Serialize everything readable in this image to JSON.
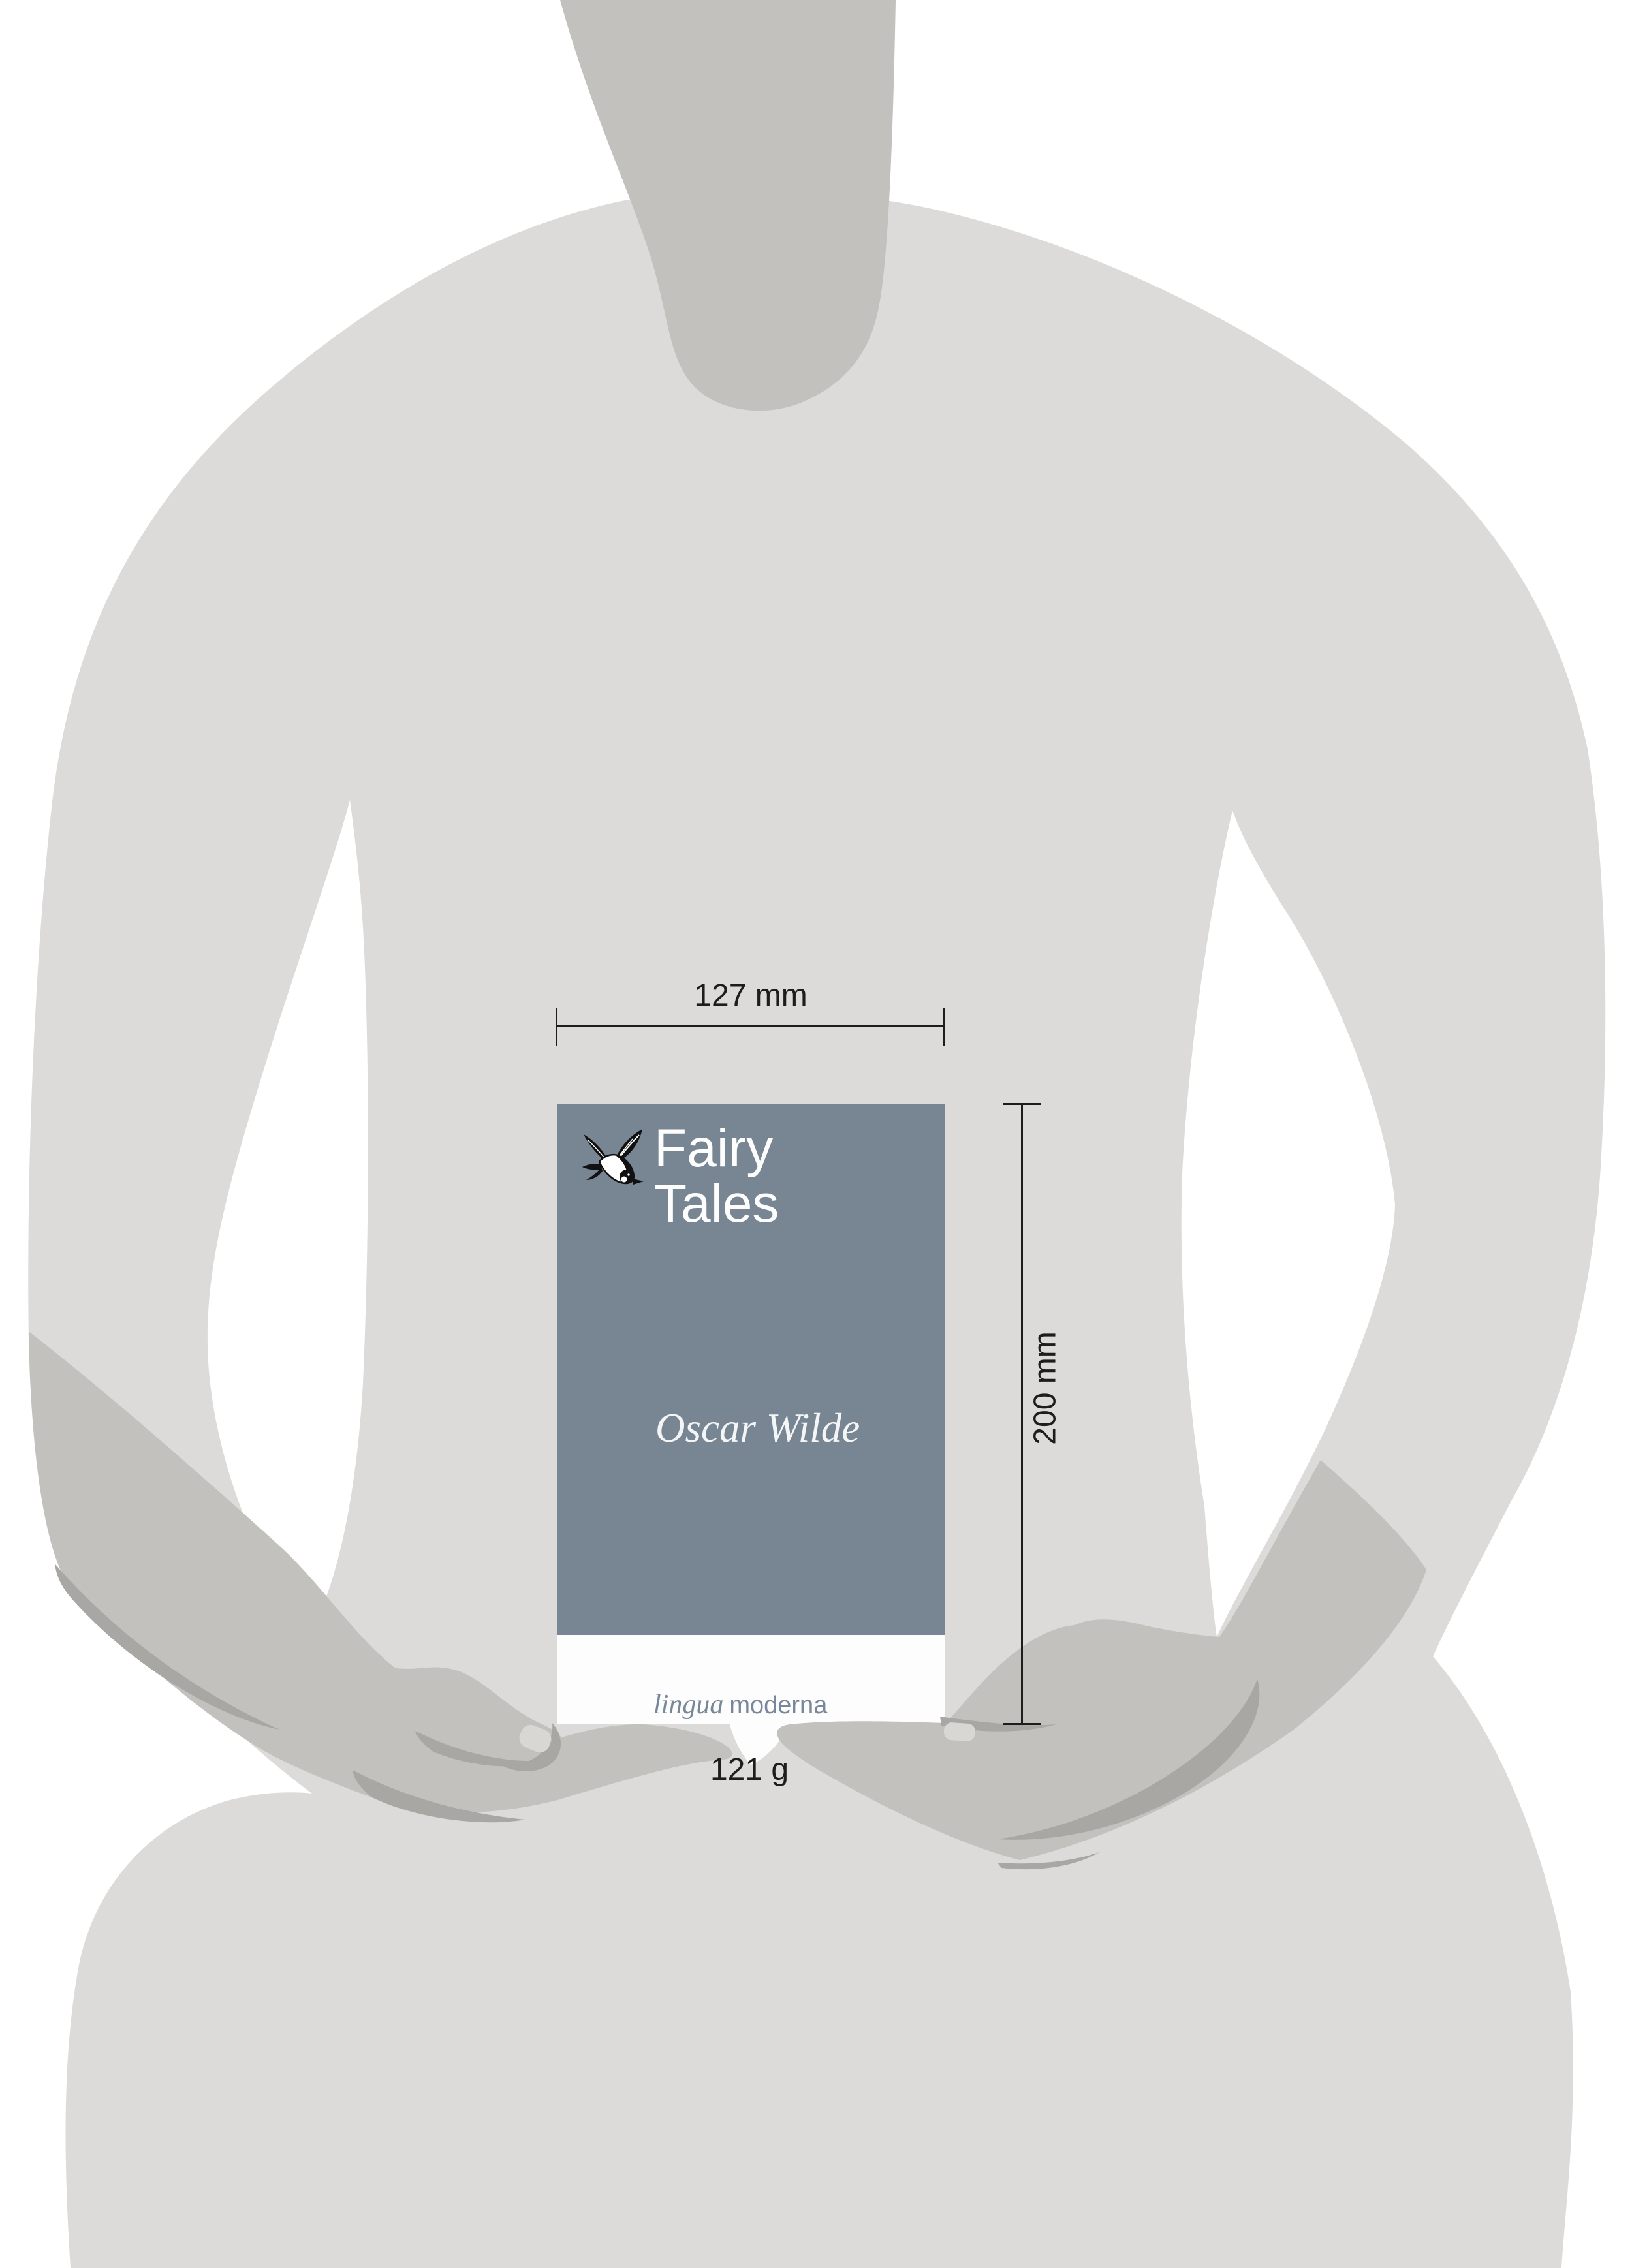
{
  "annotations": {
    "width_label": "127 mm",
    "height_label": "200 mm",
    "weight_label": "121 g",
    "line_color": "#1d1d1b"
  },
  "book": {
    "title_line1": "Fairy",
    "title_line2": "Tales",
    "author": "Oscar Wilde",
    "publisher": {
      "italic_word": "lingua",
      "regular_word": "moderna",
      "text_color": "#78879a"
    },
    "cover_color": "#788694",
    "band_color": "#fdfdfd",
    "title_color": "#fdfdfd",
    "logo_icon": "swallow-icon"
  },
  "silhouette": {
    "body_color": "#dcdbd9",
    "limb_color": "#c2c1bd",
    "shadow_color": "#a8a7a3",
    "nail_color": "#d8d7d4",
    "background_color": "#ffffff"
  }
}
